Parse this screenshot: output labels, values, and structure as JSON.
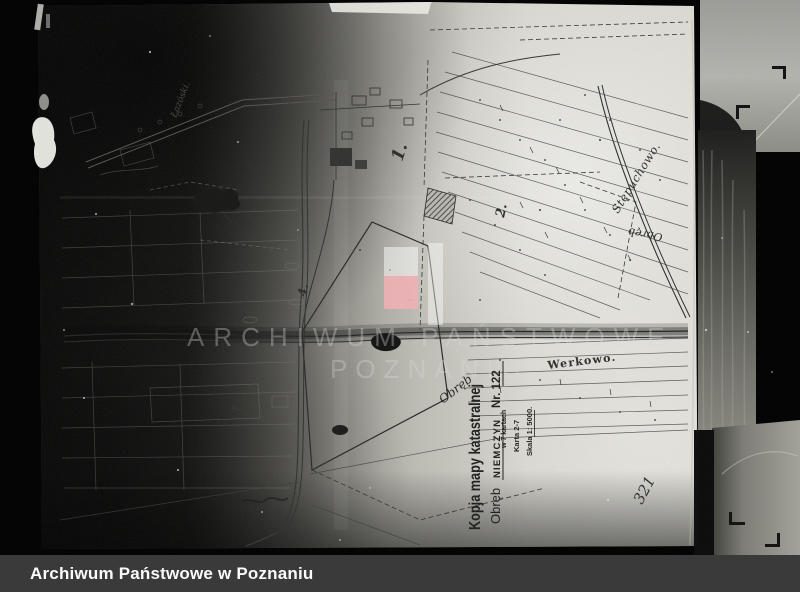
{
  "footer": {
    "label": "Archiwum Państwowe w Poznaniu"
  },
  "watermark": {
    "line1": "ARCHIWUM PAŃSTWOWE",
    "line2": "POZNANIU",
    "red": "#f2b0b4",
    "white": "#ffffff"
  },
  "map": {
    "labels": {
      "stepuchowo": "Stępuchowo.",
      "werkowo": "Werkowo.",
      "obreb_flipped": "Obręb",
      "obreb_handwritten": "Obręb",
      "corner_note": "Łazóski.",
      "page_number": "321"
    },
    "sections": {
      "s1": "1.",
      "s2": "2.",
      "s3": "3.",
      "s4": "4.",
      "s5": "5."
    },
    "stamp": {
      "title": "Kopja mapy katastralnej",
      "obreb_label": "Obręb",
      "obreb_value": "NIEMCZYN",
      "nr": "Nr. 122",
      "line_kartach": "w 7 kartach",
      "line_karta": "Karta 2-7",
      "line_skala": "Skala 1: 5000."
    }
  },
  "colors": {
    "background": "#000000",
    "paper": "#d9d8d1",
    "ink": "#22221f",
    "footer_bg": "#3a3a3a",
    "footer_text": "#fafafa"
  }
}
